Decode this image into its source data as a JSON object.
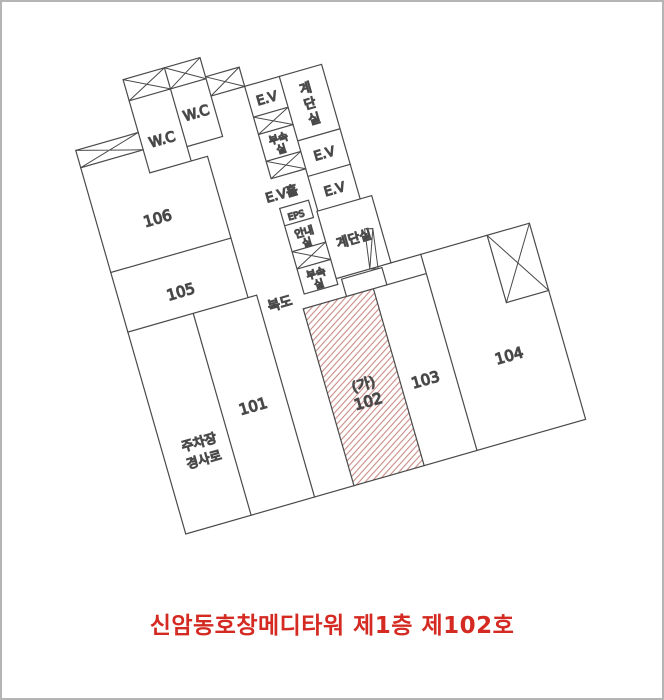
{
  "title": {
    "text": "신암동호창메디타워 제1층 제102호"
  },
  "plan": {
    "rooms": {
      "r101": "101",
      "r103": "103",
      "r104": "104",
      "r105": "105",
      "r106": "106"
    },
    "unit": {
      "mark": "(가)",
      "number": "102"
    },
    "labels": {
      "wc_left": "W.C",
      "wc_right": "W.C",
      "ev_top": "E.V",
      "ev_mid": "E.V",
      "ev_low": "E.V",
      "ev_hall": "E.V홀",
      "stair_top_c1": "계",
      "stair_top_c2": "단",
      "stair_top_c3": "실",
      "stair_mid": "계단실",
      "annex_top_l1": "부속",
      "annex_top_l2": "실",
      "eps": "EPS",
      "info_l1": "안내",
      "info_l2": "실",
      "annex_low_l1": "부속",
      "annex_low_l2": "실",
      "corridor": "복도",
      "parking_l1": "주차장",
      "parking_l2": "경사로"
    }
  },
  "colors": {
    "line": "#4a4a4a",
    "hatch": "#c98b85",
    "unit_mark": "#cc3b3b",
    "unit_number": "#2fa3bd",
    "title": "#d42a22"
  }
}
